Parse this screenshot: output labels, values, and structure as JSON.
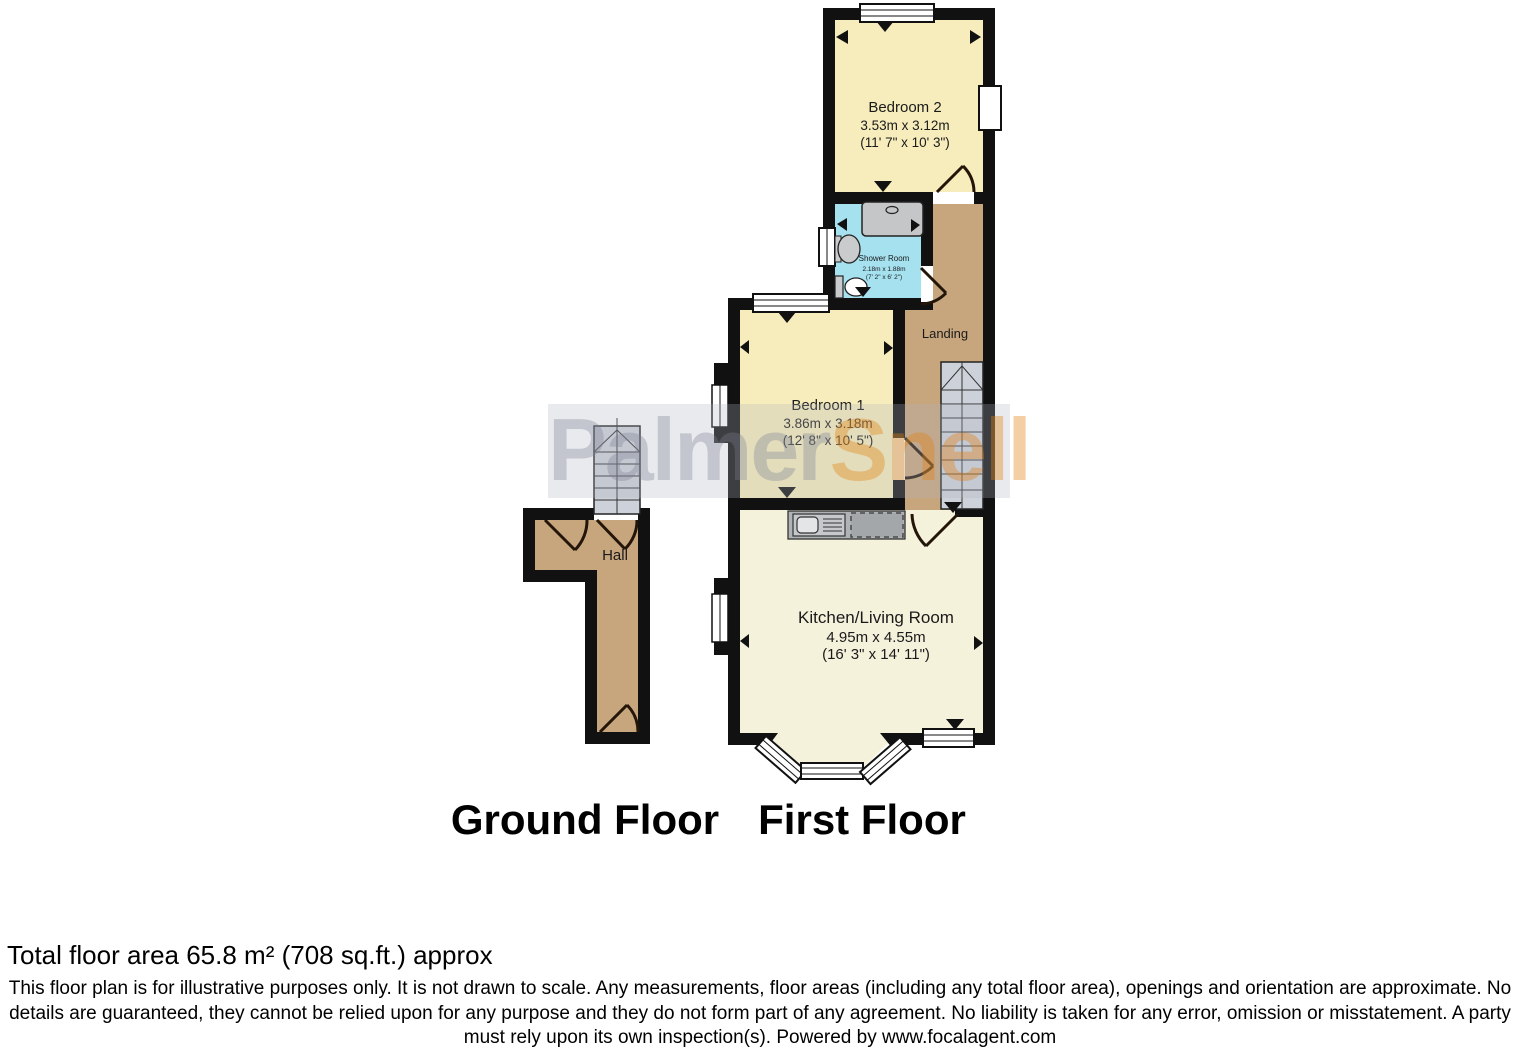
{
  "watermark": {
    "part1": "Palmer",
    "part2": "Snell"
  },
  "labels": {
    "ground_floor": "Ground Floor",
    "first_floor": "First Floor"
  },
  "rooms": {
    "bedroom2": {
      "name": "Bedroom 2",
      "dim_m": "3.53m x 3.12m",
      "dim_ft": "(11' 7\" x 10' 3\")"
    },
    "shower": {
      "name": "Shower Room",
      "dim_m": "2.18m x 1.88m",
      "dim_ft": "(7' 2\" x 6' 2\")"
    },
    "landing": {
      "name": "Landing"
    },
    "bedroom1": {
      "name": "Bedroom 1",
      "dim_m": "3.86m x 3.18m",
      "dim_ft": "(12' 8\" x 10' 5\")"
    },
    "kitchen": {
      "name": "Kitchen/Living Room",
      "dim_m": "4.95m x 4.55m",
      "dim_ft": "(16' 3\" x 14' 11\")"
    },
    "hall": {
      "name": "Hall"
    }
  },
  "footer": {
    "total_area": "Total floor area 65.8 m² (708 sq.ft.) approx",
    "disclaimer_line1": "This floor plan is for illustrative purposes only. It is not drawn to scale. Any measurements, floor areas (including any total floor area), openings and orientation are approximate. No",
    "disclaimer_line2": "details are guaranteed, they cannot be relied upon for any purpose and they do not form part of any agreement. No liability is taken for any error, omission or misstatement. A party",
    "disclaimer_line3": "must rely upon its own inspection(s). Powered by www.focalagent.com"
  },
  "colors": {
    "wall": "#111111",
    "bedroom_fill": "#F7EDBC",
    "kitchen_fill": "#F5F2DC",
    "hall_fill": "#C7A67D",
    "shower_fill": "#A5E1EF",
    "stairs_fill": "#CDD1DA",
    "counter_fill": "#B0B3B6",
    "watermark_orange": "#E28010"
  }
}
